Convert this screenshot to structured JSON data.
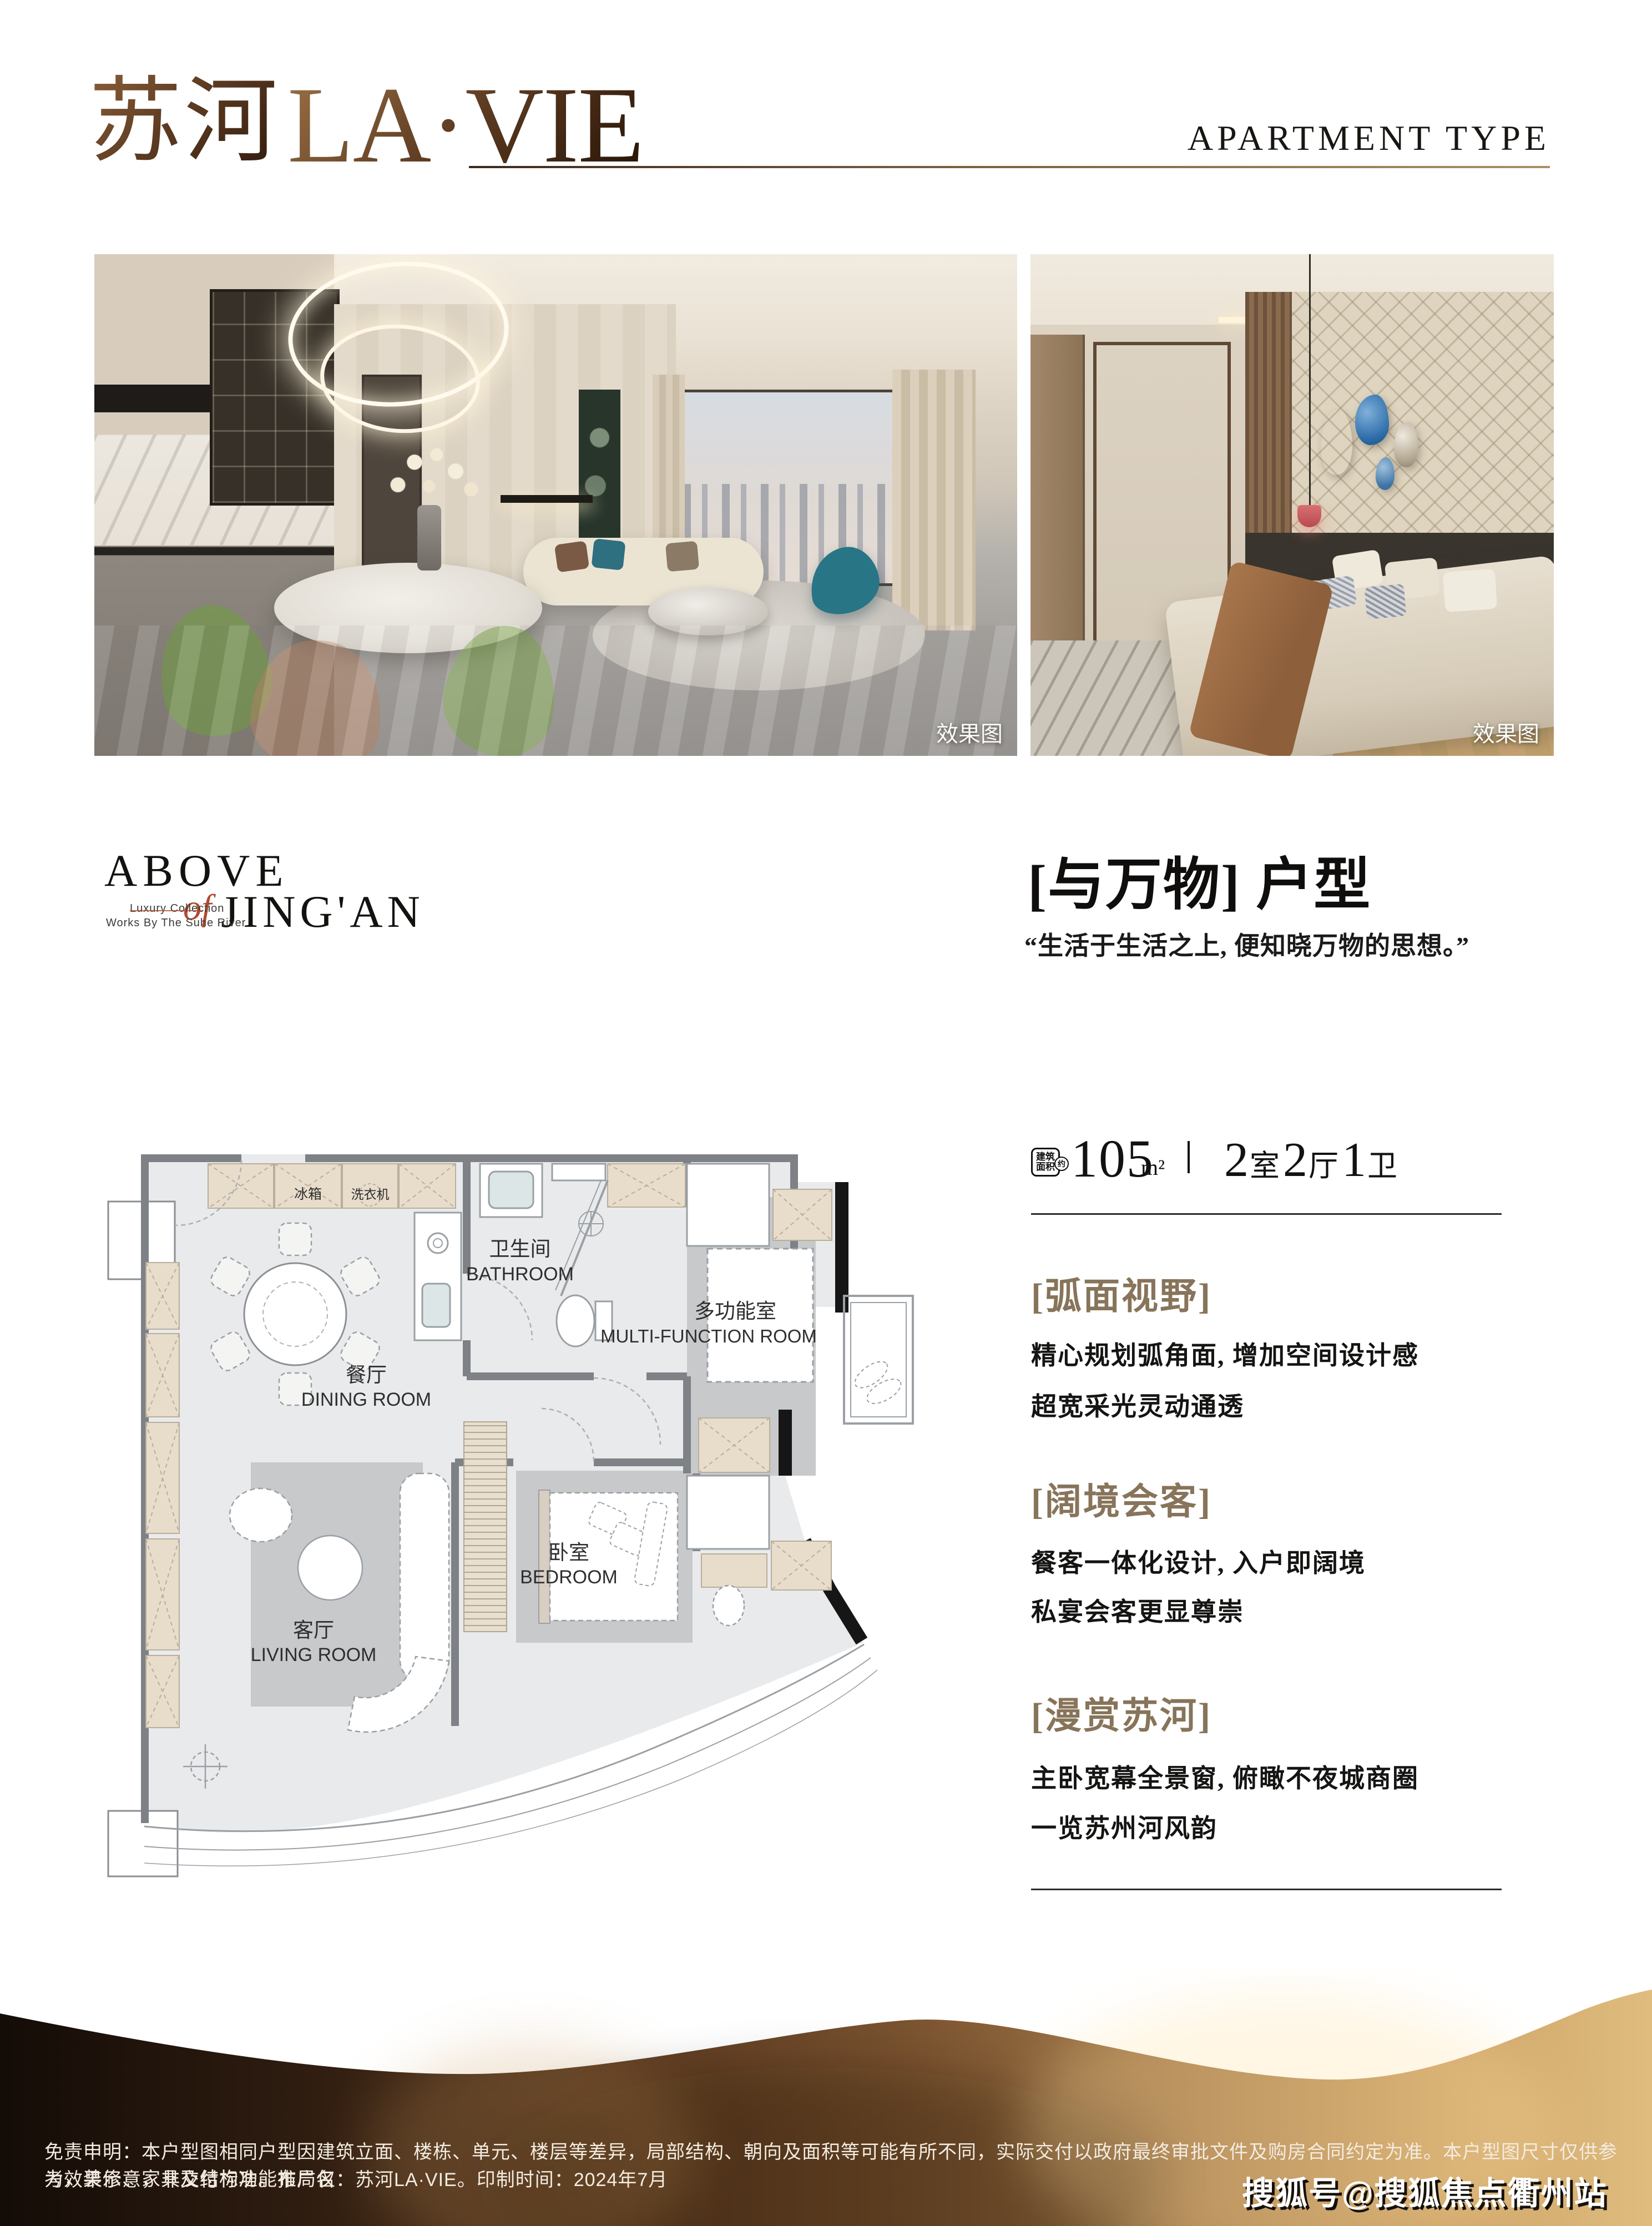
{
  "colors": {
    "accent_gold": "#8a6e4f",
    "section_title": "#87745a",
    "brand_red": "#b04a30",
    "logo_bronze": "#5d3b22"
  },
  "header": {
    "logo_cn": "苏河",
    "logo_en": "LA·VIE",
    "right_title": "APARTMENT TYPE"
  },
  "photos": {
    "effect_label": "效果图"
  },
  "brand": {
    "line1": "ABOVE",
    "script": "of",
    "line2": "JING'AN",
    "tag1": "Luxury Collection",
    "tag2": "Works By The Suhe River"
  },
  "unit": {
    "title": "[与万物] 户型",
    "quote": "“生活于生活之上, 便知晓万物的思想。”"
  },
  "area": {
    "badge_top": "建筑",
    "badge_bottom": "面积",
    "badge_about": "约",
    "value": "105",
    "unit": "m²",
    "rooms": [
      {
        "num": "2",
        "label": "室"
      },
      {
        "num": "2",
        "label": "厅"
      },
      {
        "num": "1",
        "label": "卫"
      }
    ]
  },
  "sections": [
    {
      "title": "[弧面视野]",
      "lines": [
        "精心规划弧角面, 增加空间设计感",
        "超宽采光灵动通透"
      ]
    },
    {
      "title": "[阔境会客]",
      "lines": [
        "餐客一体化设计, 入户即阔境",
        "私宴会客更显尊崇"
      ]
    },
    {
      "title": "[漫赏苏河]",
      "lines": [
        "主卧宽幕全景窗, 俯瞰不夜城商圈",
        "一览苏州河风韵"
      ]
    }
  ],
  "floorplan": {
    "fridge": "冰箱",
    "washer": "洗衣机",
    "bathroom_cn": "卫生间",
    "bathroom_en": "BATHROOM",
    "multi_cn": "多功能室",
    "multi_en": "MULTI-FUNCTION ROOM",
    "dining_cn": "餐厅",
    "dining_en": "DINING ROOM",
    "living_cn": "客厅",
    "living_en": "LIVING ROOM",
    "bedroom_cn": "卧室",
    "bedroom_en": "BEDROOM"
  },
  "footer": {
    "disclaimer1": "免责申明：本户型图相同户型因建筑立面、楼栋、单元、楼层等差异，局部结构、朝向及面积等可能有所不同，实际交付以政府最终审批文件及购房合同约定为准。本户型图尺寸仅供参考，装修、家具及结构功能布局仅",
    "disclaimer2": "为效果示意，非交付标准。推广名：苏河LA·VIE。印制时间：2024年7月",
    "watermark": "搜狐号@搜狐焦点衢州站"
  }
}
